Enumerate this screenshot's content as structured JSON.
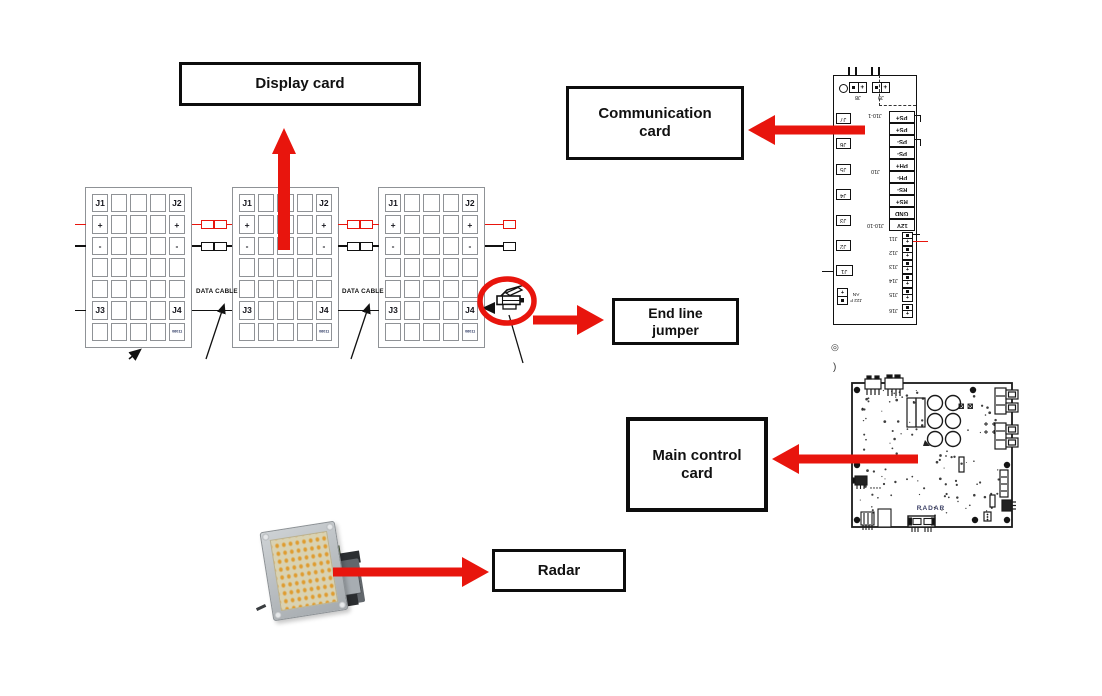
{
  "boxes": {
    "display_card": {
      "lines": [
        "Display card"
      ]
    },
    "communication_card": {
      "lines": [
        "Communication",
        "card"
      ]
    },
    "end_line_jumper": {
      "lines": [
        "End line",
        "jumper"
      ]
    },
    "main_control_card": {
      "lines": [
        "Main control",
        "card"
      ]
    },
    "radar": {
      "lines": [
        "Radar"
      ]
    }
  },
  "display_panels": {
    "count": 3,
    "data_cable_label": "DATA CABLE",
    "serial": "06011",
    "connector_labels": {
      "top_left": "J1",
      "top_right": "J2",
      "plus": "+",
      "minus": "-",
      "bottom_left": "J3",
      "bottom_right": "J4"
    }
  },
  "communication_card": {
    "top_terminals": [
      "J8",
      "J9"
    ],
    "left_connectors": [
      "J7",
      "J6",
      "J5",
      "J4",
      "J3",
      "J2",
      "J1"
    ],
    "io_terminals": [
      "PS+",
      "PS+",
      "PS-",
      "PS-",
      "PH+",
      "PH-",
      "RS-",
      "RS+",
      "GND",
      "12V"
    ],
    "io_group_labels": [
      "J10-1",
      "J10",
      "J10-10"
    ],
    "power_terminals": [
      "J11",
      "J12",
      "J13",
      "J14",
      "J15",
      "J16"
    ],
    "fan_terminal": "J22 FAN",
    "polarity": {
      "plus": "+",
      "minus": "-"
    }
  },
  "main_control_card": {
    "silkscreen": "RADAR",
    "stray_marks": [
      "◎",
      ")"
    ]
  },
  "colors": {
    "arrow_red": "#e8150d",
    "panel_gray": "#8f9296",
    "ink_black": "#111111"
  }
}
